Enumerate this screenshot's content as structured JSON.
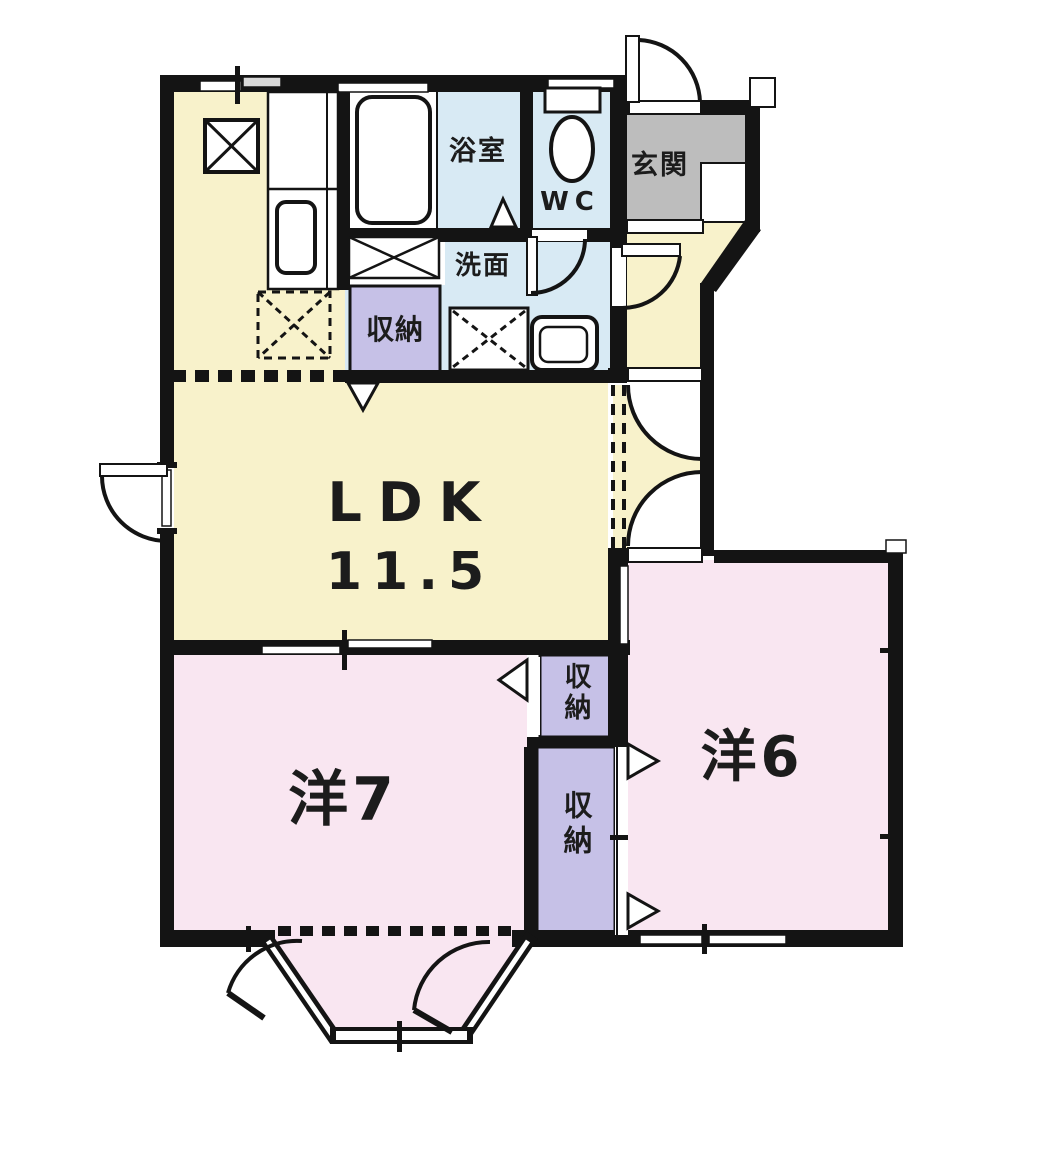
{
  "colors": {
    "wall": "#141414",
    "floor_yellow": "#f8f2cb",
    "floor_pink": "#f9e6f1",
    "floor_blue": "#d8eaf4",
    "closet_lavender": "#c6c1e7",
    "entrance_gray": "#bdbdbd",
    "text": "#1c1c1c"
  },
  "rooms": {
    "bath": {
      "label": "浴室"
    },
    "wc": {
      "label": "WC"
    },
    "entrance": {
      "label": "玄関"
    },
    "washroom": {
      "label": "洗面"
    },
    "hall_storage": {
      "label": "収納"
    },
    "ldk": {
      "label": "LDK",
      "area": "11.5"
    },
    "west7": {
      "label": "洋7"
    },
    "west7_storage": {
      "label": "収納"
    },
    "west6": {
      "label": "洋6"
    },
    "west6_storage": {
      "label": "収納"
    }
  }
}
